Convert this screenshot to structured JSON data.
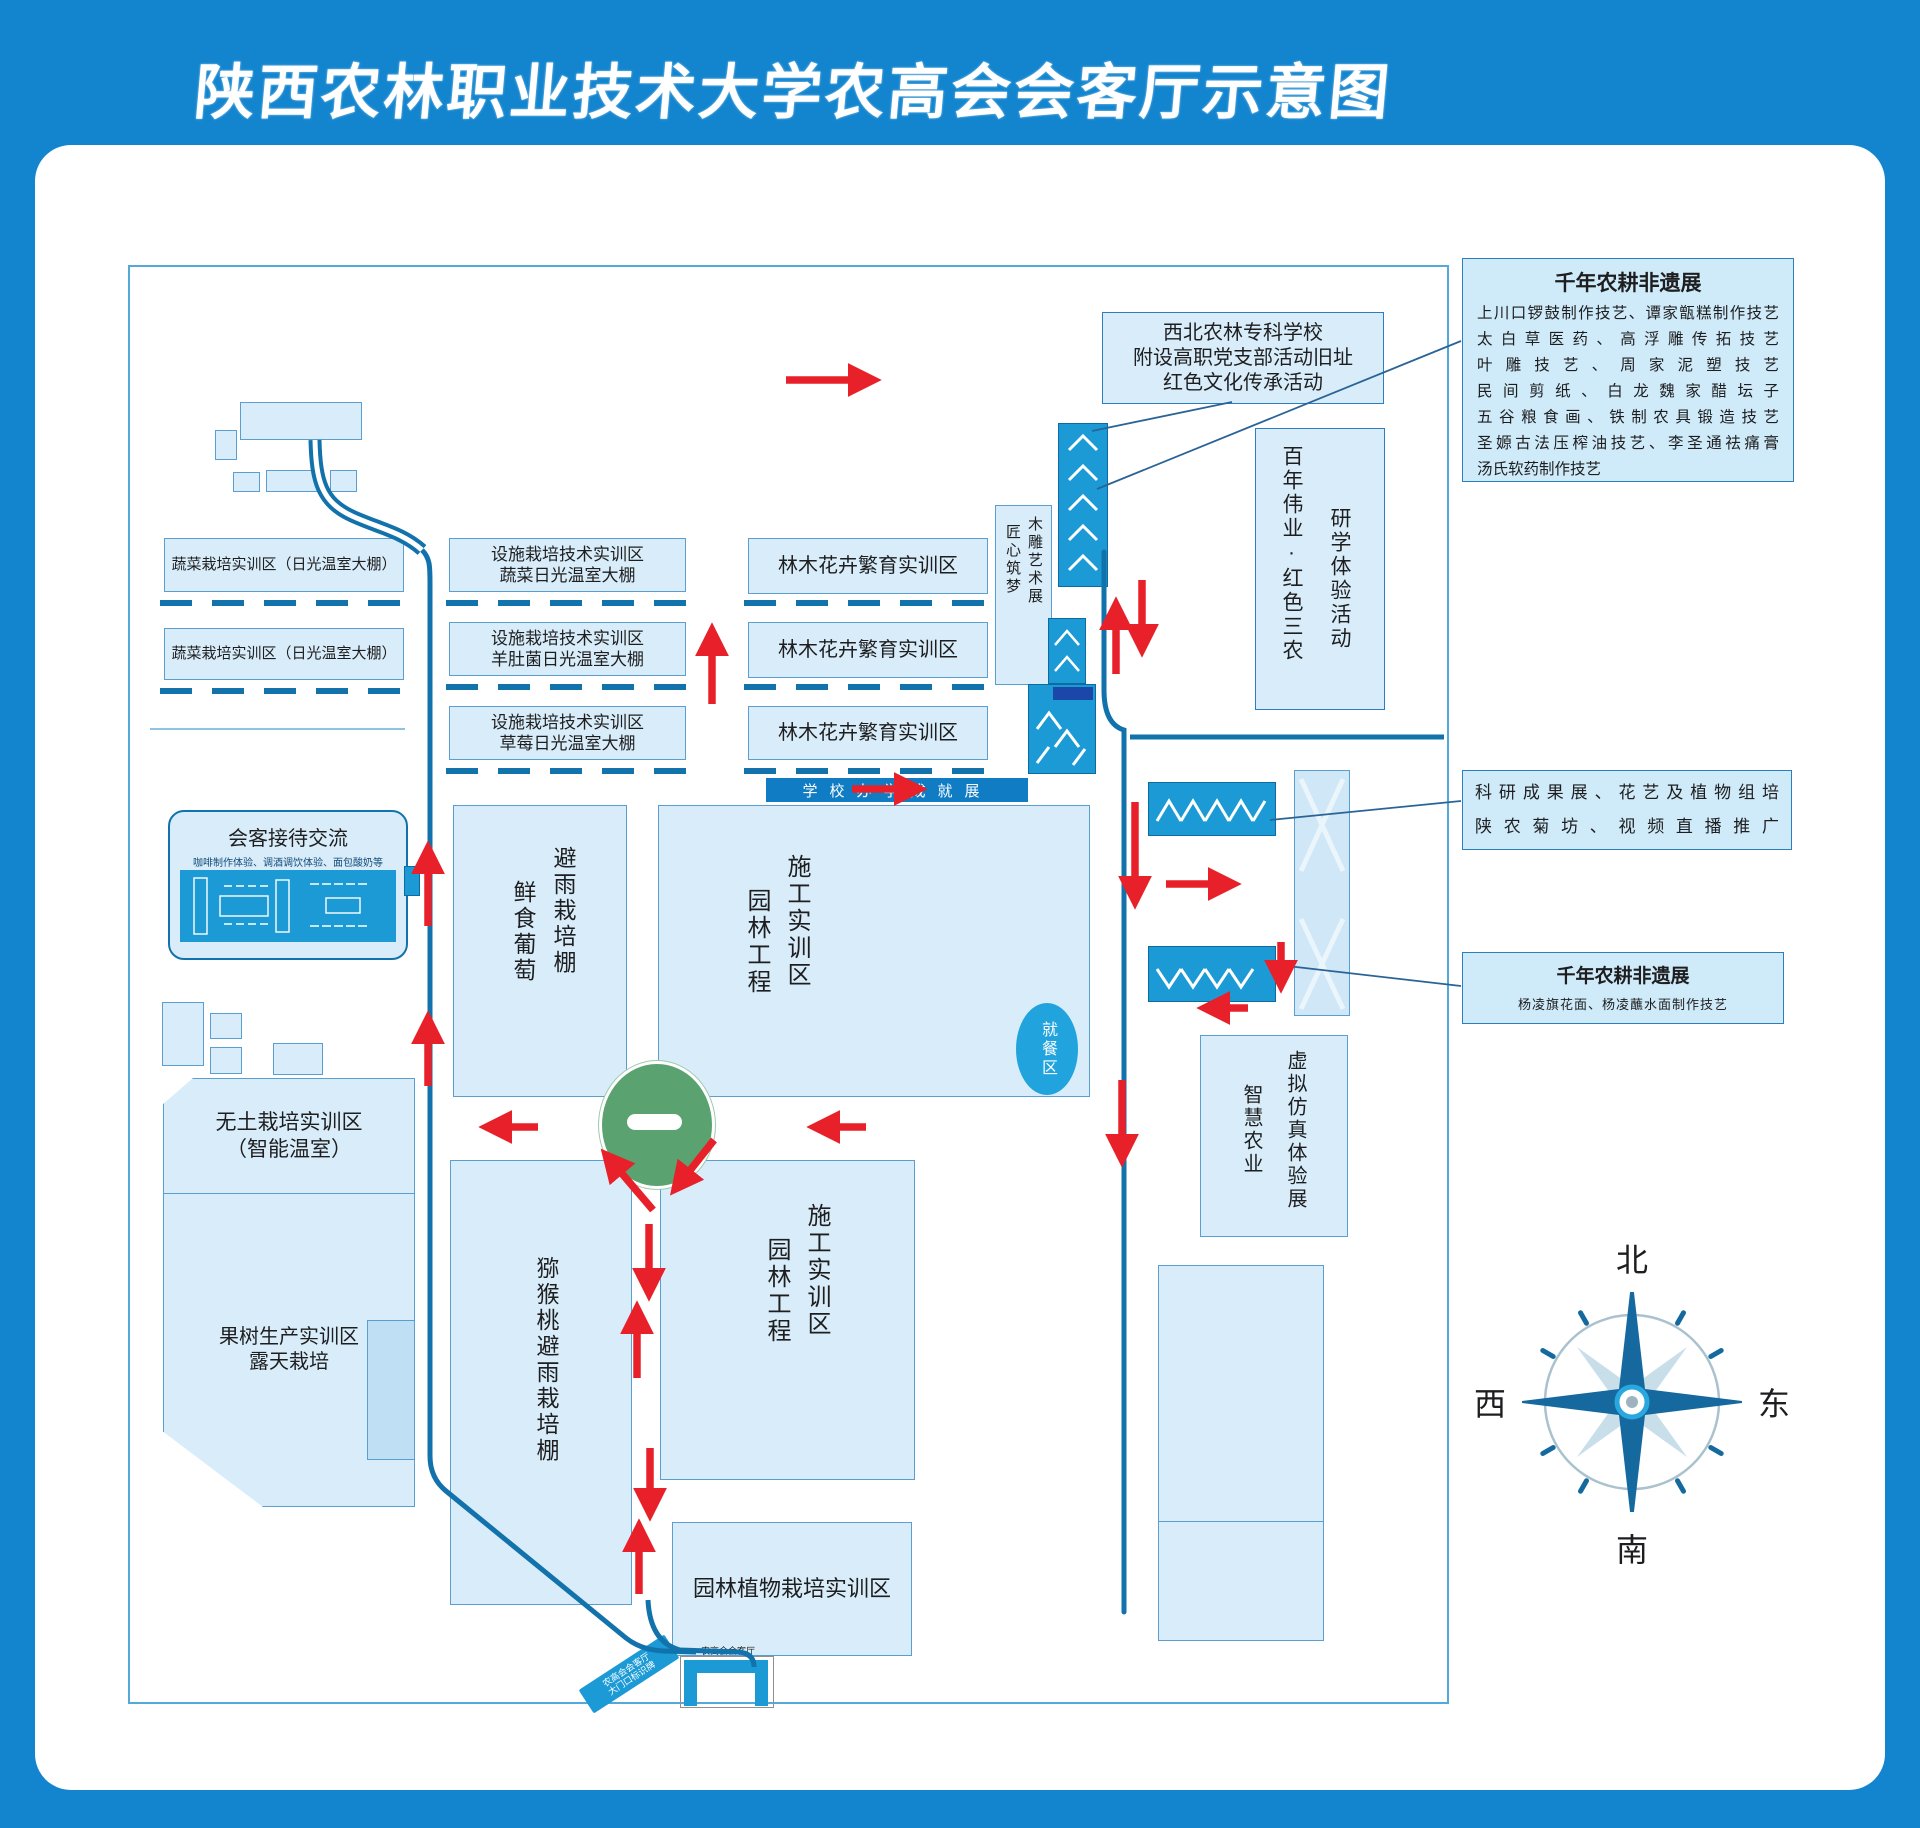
{
  "title": "陕西农林职业技术大学农高会会客厅示意图",
  "blocks": {
    "veg1": "蔬菜栽培实训区（日光温室大棚）",
    "veg2": "蔬菜栽培实训区（日光温室大棚）",
    "fac1": {
      "l1": "设施栽培技术实训区",
      "l2": "蔬菜日光温室大棚"
    },
    "fac2": {
      "l1": "设施栽培技术实训区",
      "l2": "羊肚菌日光温室大棚"
    },
    "fac3": {
      "l1": "设施栽培技术实训区",
      "l2": "草莓日光温室大棚"
    },
    "forest1": "林木花卉繁育实训区",
    "forest2": "林木花卉繁育实训区",
    "forest3": "林木花卉繁育实训区",
    "wood_art": {
      "l1": "木雕艺术展",
      "l2": "匠心筑梦"
    },
    "school_site": {
      "l1": "西北农林专科学校",
      "l2": "附设高职党支部活动旧址",
      "l3": "红色文化传承活动"
    },
    "century": {
      "l1": "百年伟业·红色三农",
      "l2": "研学体验活动"
    },
    "achievement_band": "学校办学成就展",
    "grape": {
      "l1": "避雨栽培棚",
      "l2": "鲜食葡萄"
    },
    "landscape1": {
      "l1": "施工实训区",
      "l2": "园林工程"
    },
    "dining": "就餐区",
    "reception": {
      "title": "会客接待交流",
      "subtitle": "咖啡制作体验、调酒调饮体验、面包酸奶等"
    },
    "soilless": {
      "l1": "无土栽培实训区",
      "l2": "（智能温室）"
    },
    "fruit": {
      "l1": "果树生产实训区",
      "l2": "露天栽培"
    },
    "kiwi": "猕猴桃避雨栽培棚",
    "landscape2": {
      "l1": "施工实训区",
      "l2": "园林工程"
    },
    "garden_plants": "园林植物栽培实训区",
    "vr": {
      "l1": "虚拟仿真体验展",
      "l2": "智慧农业"
    },
    "gate": {
      "label": "农高会会客厅",
      "banner_l1": "农高会会客厅",
      "banner_l2": "大门口标识牌"
    }
  },
  "legends": {
    "heritage_main": {
      "title": "千年农耕非遗展",
      "lines": [
        "上川口锣鼓制作技艺、谭家甑糕制作技艺",
        "太白草医药、高浮雕传拓技艺",
        "叶雕技艺、周家泥塑技艺",
        "民间剪纸、白龙魏家醋坛子",
        "五谷粮食画、铁制农具锻造技艺",
        "圣嫄古法压榨油技艺、李圣通祛痛膏",
        "汤氏软药制作技艺"
      ]
    },
    "research": {
      "l1": "科研成果展、花艺及植物组培",
      "l2": "陕农菊坊、视频直播推广"
    },
    "heritage_small": {
      "title": "千年农耕非遗展",
      "subtitle": "杨凌旗花面、杨凌蘸水面制作技艺"
    }
  },
  "compass": {
    "north": "北",
    "south": "南",
    "west": "西",
    "east": "东"
  },
  "colors": {
    "bg-blue": "#1385cf",
    "block-fill": "#d8edf9",
    "block-border": "#5b9fd0",
    "bright-blue": "#1b9ad6",
    "road-blue": "#1272ab",
    "arrow-red": "#e8202a",
    "green": "#5ba271",
    "legend-fill": "#cfeaf8",
    "legend-border": "#2b7fc1",
    "band-blue": "#0f7cc4"
  }
}
